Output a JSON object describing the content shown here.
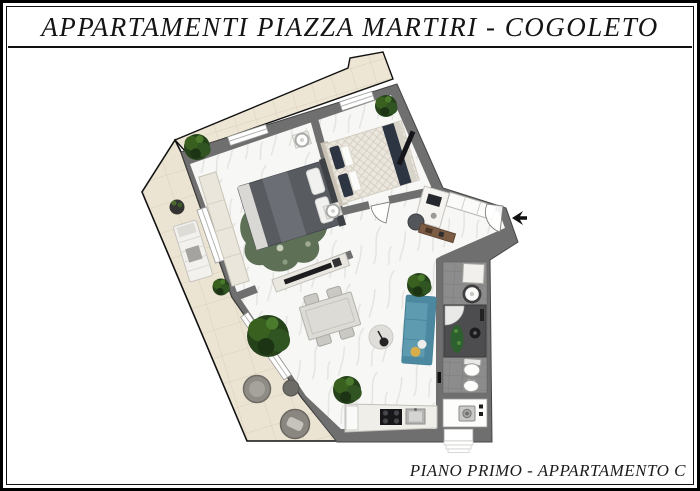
{
  "header": {
    "title": "APPARTAMENTI PIAZZA MARTIRI - COGOLETO"
  },
  "footer": {
    "caption": "PIANO PRIMO - APPARTAMENTO C"
  },
  "icons": {
    "entrance_arrow": "left-arrow"
  },
  "colors": {
    "frame": "#000000",
    "outline": "#111111",
    "wall": "#6f6f6f",
    "marble_floor": "#f7f7f5",
    "marble_vein": "#e3e3e1",
    "terrace_tile": "#ece4d2",
    "terrace_line": "#d9cfba",
    "balcony_tile": "#eee6d5",
    "bath_floor": "#8c8c8c",
    "bath_line": "#7c7c7c",
    "shower": "#4d4d4f",
    "bed_dark": "#585c60",
    "bed_light": "#ece7de",
    "pillow_navy": "#2d3543",
    "rug_green": "#5e7156",
    "sofa": "#5f9bb0",
    "sofa_dark": "#4c88a0",
    "plant": "#25421b",
    "wood": "#7c5d44",
    "cushion_yellow": "#d8ae4c"
  }
}
